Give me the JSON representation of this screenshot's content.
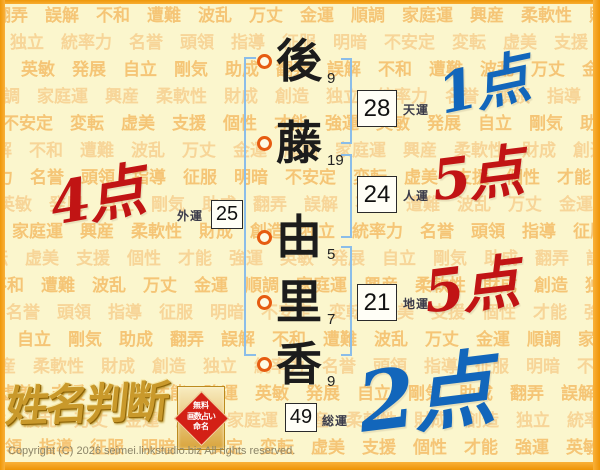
{
  "background": {
    "words": [
      "翻弄",
      "誤解",
      "不和",
      "遭難",
      "波乱",
      "万丈",
      "金運",
      "順調",
      "家庭運",
      "興産",
      "柔軟性",
      "財成",
      "創造",
      "独立",
      "統率力",
      "名誉",
      "頭領",
      "指導",
      "征服",
      "明暗",
      "不安定",
      "変転",
      "虚美",
      "支援",
      "個性",
      "才能",
      "強運",
      "英敏",
      "発展",
      "自立",
      "剛気",
      "助成"
    ]
  },
  "name": {
    "characters": [
      {
        "char": "後",
        "strokes": "9"
      },
      {
        "char": "藤",
        "strokes": "19"
      },
      {
        "char": "由",
        "strokes": "5"
      },
      {
        "char": "里",
        "strokes": "7"
      },
      {
        "char": "香",
        "strokes": "9"
      }
    ]
  },
  "fortunes": {
    "heaven": {
      "value": "28",
      "label": "天運",
      "score": "1点"
    },
    "person": {
      "value": "24",
      "label": "人運",
      "score": "5点"
    },
    "earth": {
      "value": "21",
      "label": "地運",
      "score": "5点"
    },
    "outer": {
      "value": "25",
      "label": "外運",
      "score": "4点"
    },
    "total": {
      "value": "49",
      "label": "総運",
      "score": "2点"
    }
  },
  "logo": {
    "title": "姓名判断",
    "seal": {
      "line1": "無料",
      "line2": "画数占い",
      "line3": "命名"
    }
  },
  "footer": {
    "copyright": "Copyright (C) 2026 seimei.linkstudio.biz All rights reserved."
  },
  "colors": {
    "score_red": "#c11414",
    "score_blue": "#1266bb",
    "bracket_blue": "#8abde9",
    "circle_ring": "#e65c11",
    "frame_orange": "#f5a11c",
    "page_bg": "#fbf6cd",
    "bg_word": "#f3bc66",
    "seal_red": "#d32016",
    "logo_gold": "#c9992b"
  }
}
